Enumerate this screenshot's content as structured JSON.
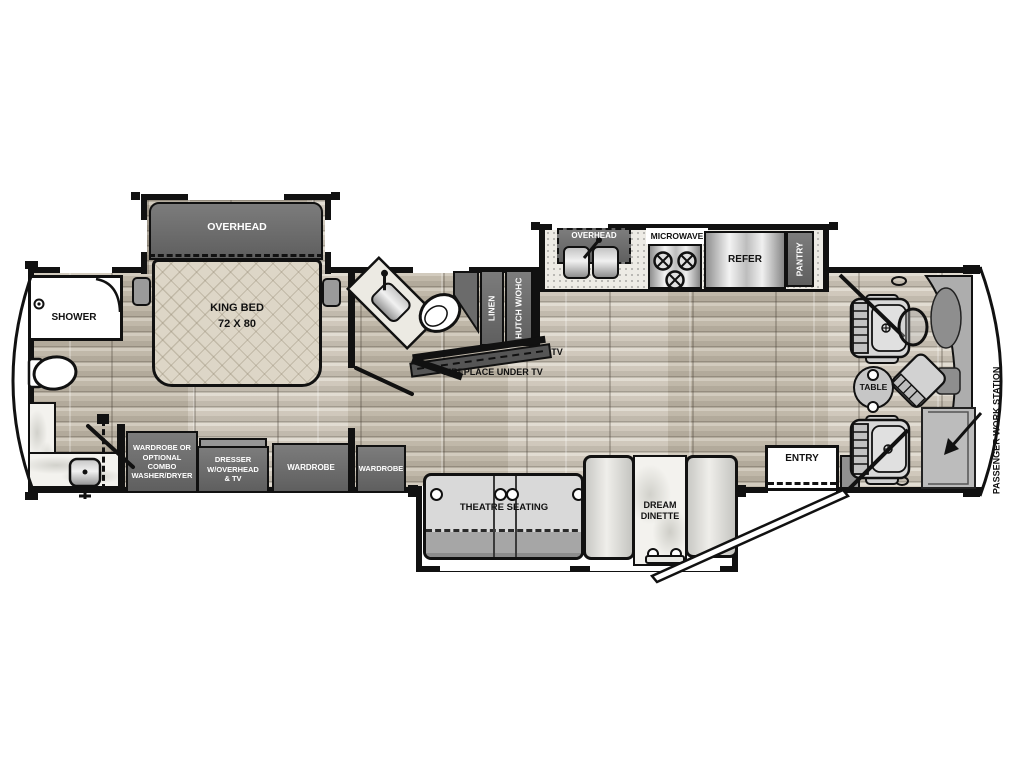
{
  "colors": {
    "wall": "#111111",
    "cabinet_dark": "#6b6b6b",
    "cabinet_text": "#ffffff",
    "floor_wood": "#c9c1b2",
    "bed_fabric": "#ddd6c7",
    "seat_gray": "#d8d8d8",
    "label_text": "#111111",
    "background": "#ffffff"
  },
  "rooms": {
    "bedroom": {
      "overhead": "OVERHEAD",
      "bed": "KING BED",
      "bed_size": "72 X 80",
      "shower": "SHOWER",
      "wardrobe_combo": "WARDROBE OR\nOPTIONAL\nCOMBO\nWASHER/DRYER",
      "dresser": "DRESSER\nW/OVERHEAD\n& TV",
      "wardrobe_left": "WARDROBE",
      "wardrobe_right": "WARDROBE"
    },
    "bath": {
      "linen": "LINEN",
      "hutch": "HUTCH W/OHC"
    },
    "living": {
      "tv": "TV",
      "fireplace": "FIREPLACE UNDER TV",
      "theatre": "THEATRE SEATING",
      "dinette": "DREAM\nDINETTE"
    },
    "kitchen": {
      "overhead": "OVERHEAD",
      "microwave": "MICROWAVE",
      "refrigerator": "REFER",
      "pantry": "PANTRY"
    },
    "cockpit": {
      "table": "TABLE",
      "entry": "ENTRY",
      "workstation": "PASSENGER\nWORK STATION"
    }
  }
}
